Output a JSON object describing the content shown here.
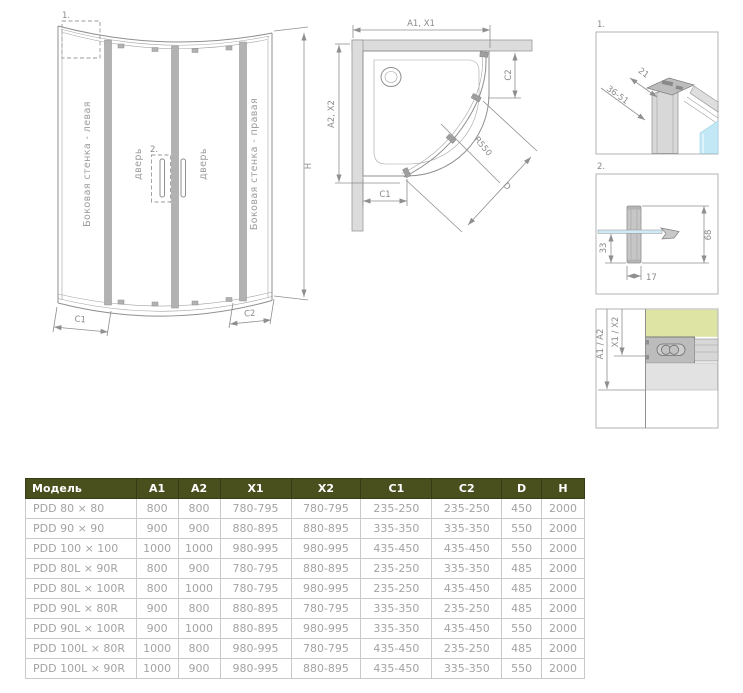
{
  "front_view": {
    "marker_1": "1.",
    "marker_2": "2.",
    "label_left_wall": "Боковая стенка - левая",
    "label_door_left": "дверь",
    "label_door_right": "дверь",
    "label_right_wall": "Боковая стенка - правая",
    "dim_h": "H",
    "dim_c1": "C1",
    "dim_c2": "C2"
  },
  "top_view": {
    "dim_width": "A1, X1",
    "dim_depth": "A2, X2",
    "dim_c2": "C2",
    "dim_c1": "C1",
    "dim_radius": "R550",
    "dim_diagonal": "D"
  },
  "detail_1": {
    "marker": "1.",
    "dim_depth": "21",
    "dim_range": "36-51"
  },
  "detail_2": {
    "marker": "2.",
    "dim_offset": "33",
    "dim_height": "68",
    "dim_width": "17"
  },
  "detail_3": {
    "dim_total": "A1 / A2",
    "dim_glass": "X1 / X2"
  },
  "table": {
    "headers": [
      "Модель",
      "A1",
      "A2",
      "X1",
      "X2",
      "C1",
      "C2",
      "D",
      "H"
    ],
    "rows": [
      [
        "PDD 80 × 80",
        "800",
        "800",
        "780-795",
        "780-795",
        "235-250",
        "235-250",
        "450",
        "2000"
      ],
      [
        "PDD 90 × 90",
        "900",
        "900",
        "880-895",
        "880-895",
        "335-350",
        "335-350",
        "550",
        "2000"
      ],
      [
        "PDD 100 × 100",
        "1000",
        "1000",
        "980-995",
        "980-995",
        "435-450",
        "435-450",
        "550",
        "2000"
      ],
      [
        "PDD 80L × 90R",
        "800",
        "900",
        "780-795",
        "880-895",
        "235-250",
        "335-350",
        "485",
        "2000"
      ],
      [
        "PDD 80L × 100R",
        "800",
        "1000",
        "780-795",
        "980-995",
        "235-250",
        "435-450",
        "485",
        "2000"
      ],
      [
        "PDD 90L × 80R",
        "900",
        "800",
        "880-895",
        "780-795",
        "335-350",
        "235-250",
        "485",
        "2000"
      ],
      [
        "PDD 90L × 100R",
        "900",
        "1000",
        "880-895",
        "980-995",
        "335-350",
        "435-450",
        "550",
        "2000"
      ],
      [
        "PDD 100L × 80R",
        "1000",
        "800",
        "980-995",
        "780-795",
        "435-450",
        "235-250",
        "485",
        "2000"
      ],
      [
        "PDD 100L × 90R",
        "1000",
        "900",
        "980-995",
        "880-895",
        "435-450",
        "335-350",
        "550",
        "2000"
      ]
    ]
  },
  "colors": {
    "header_bg": "#49501e",
    "header_text": "#ffffff",
    "cell_text": "#a3a3a3",
    "line": "#8f8f8f",
    "glass_blue": "#c2e8f6",
    "wall_green": "#dde4a4"
  }
}
